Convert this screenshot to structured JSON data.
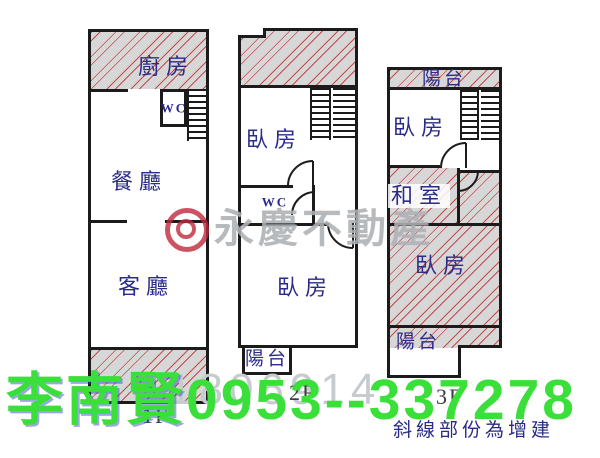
{
  "floor1": {
    "label": "1F",
    "kitchen": "廚房",
    "wc": "WC",
    "dining": "餐廳",
    "living": "客廳"
  },
  "floor2": {
    "label": "2F",
    "bedroom_upper": "臥房",
    "wc": "WC",
    "bedroom_main": "臥房",
    "balcony": "陽台"
  },
  "floor3": {
    "label": "3F",
    "balcony_top": "陽台",
    "bedroom_upper": "臥房",
    "tatami_room": "和室",
    "bedroom_main": "臥房",
    "balcony_bottom": "陽台"
  },
  "watermark": {
    "brand": "永慶不動產",
    "listing_number": "1806914"
  },
  "contact": {
    "agent_name": "李南賢",
    "phone": "0953--337278"
  },
  "note": {
    "text": "斜線部份為增建"
  },
  "colors": {
    "contact_green": "#3adf3a",
    "label_navy": "#2b2b8a",
    "wall_black": "#1b1b1b",
    "hatch_fill_gray": "#d7d7d7",
    "hatch_line_red": "#be3c3c",
    "watermark_gray": "#aeb1b5",
    "listing_number_gray": "#c7cbcf",
    "logo_red": "#c1293d"
  }
}
